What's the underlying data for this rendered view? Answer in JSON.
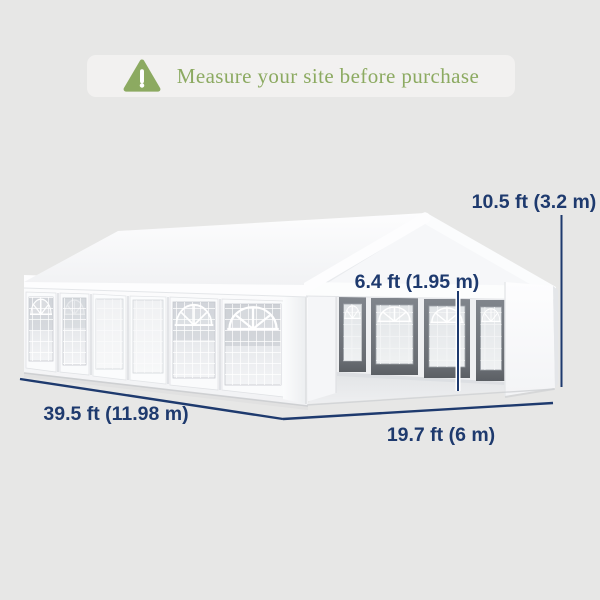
{
  "banner": {
    "icon": "warning-triangle-icon",
    "text": "Measure your site before purchase"
  },
  "diagram": {
    "dimensions": {
      "total_height": "10.5 ft (3.2 m)",
      "side_height": "6.4 ft (1.95 m)",
      "length": "39.5 ft (11.98 m)",
      "width": "19.7 ft (6 m)"
    }
  },
  "colors": {
    "background": "#e7e7e6",
    "banner_bg": "#f2f1f0",
    "accent_green": "#8caa61",
    "accent_navy": "#1e3a6e",
    "tent_white": "#fbfcfd",
    "interior_frame_gray": "#75797f"
  }
}
